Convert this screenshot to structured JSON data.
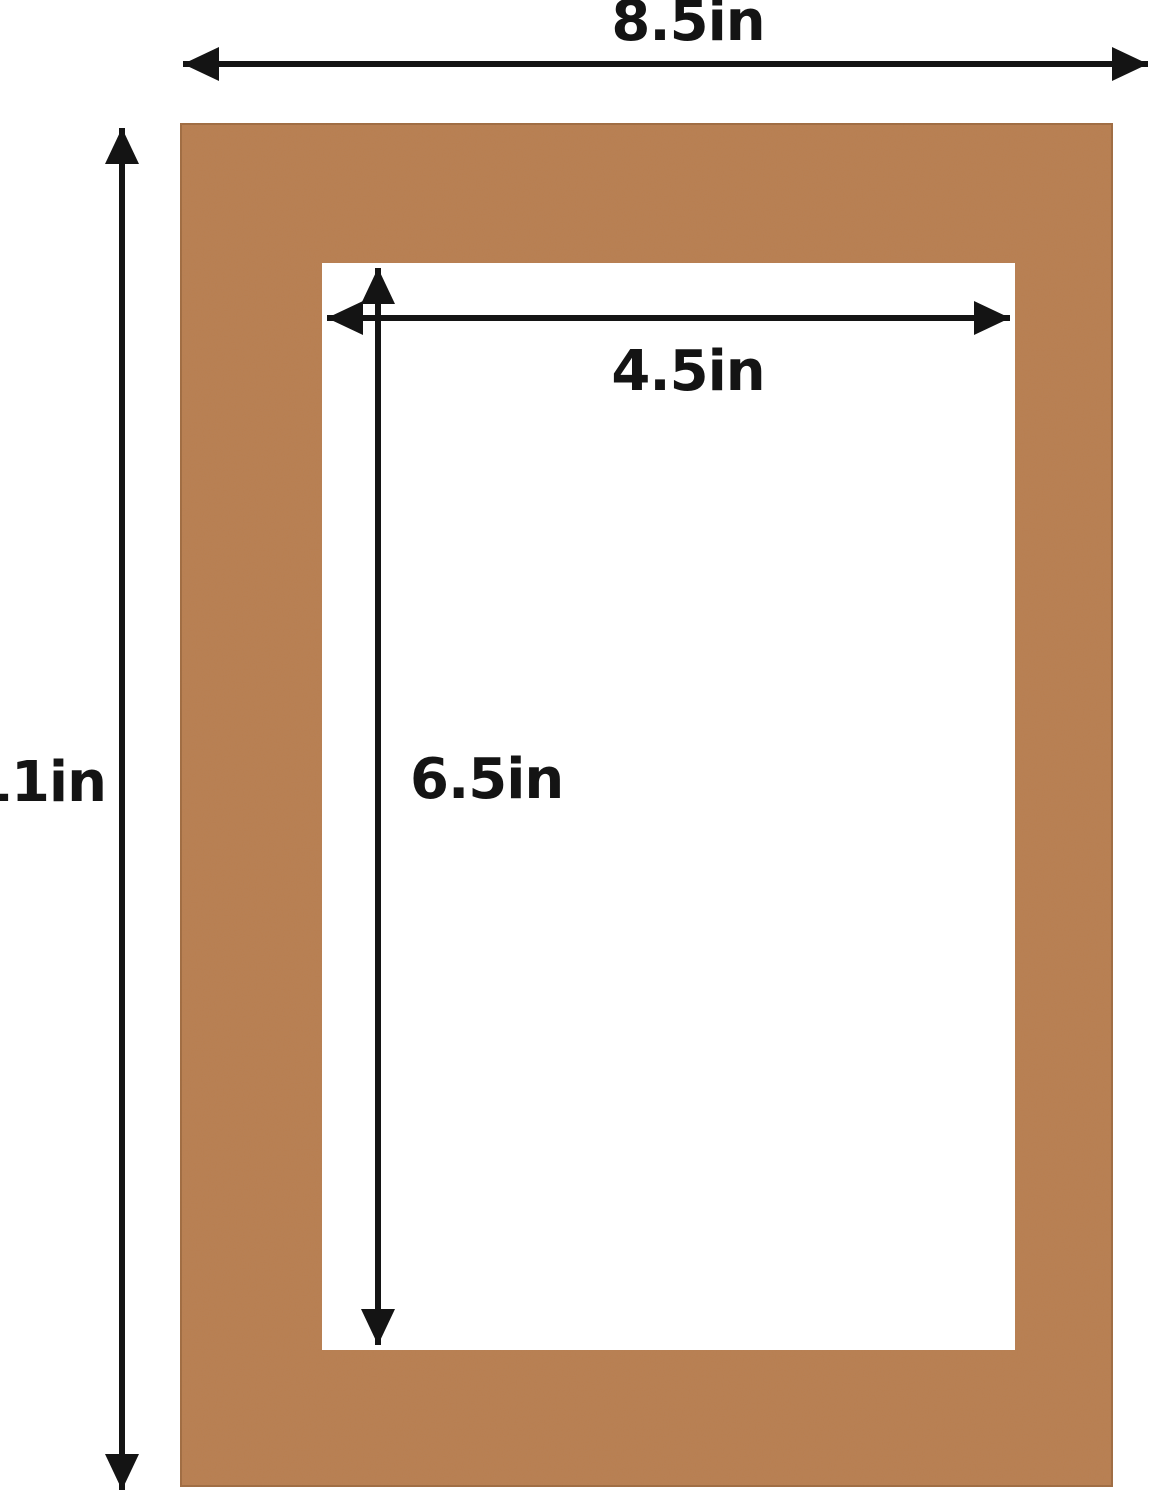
{
  "diagram": {
    "type": "product-dimension-diagram",
    "subject": "picture frame mat board with rectangular opening",
    "background_color": "#ffffff",
    "mat_board": {
      "material_color": "#b97e50",
      "texture": "kraft-paper-speckle",
      "opening_color": "#ffffff"
    },
    "colors": {
      "arrow": "#141414",
      "label_text": "#141414"
    },
    "dimensions": {
      "outer_width": {
        "label": "8.5in",
        "measures": "outer width of mat board"
      },
      "outer_height": {
        "label": "11in",
        "measures": "outer height of mat board"
      },
      "opening_width": {
        "label": "4.5in",
        "measures": "width of mat opening"
      },
      "opening_height": {
        "label": "6.5in",
        "measures": "height of mat opening"
      }
    }
  }
}
